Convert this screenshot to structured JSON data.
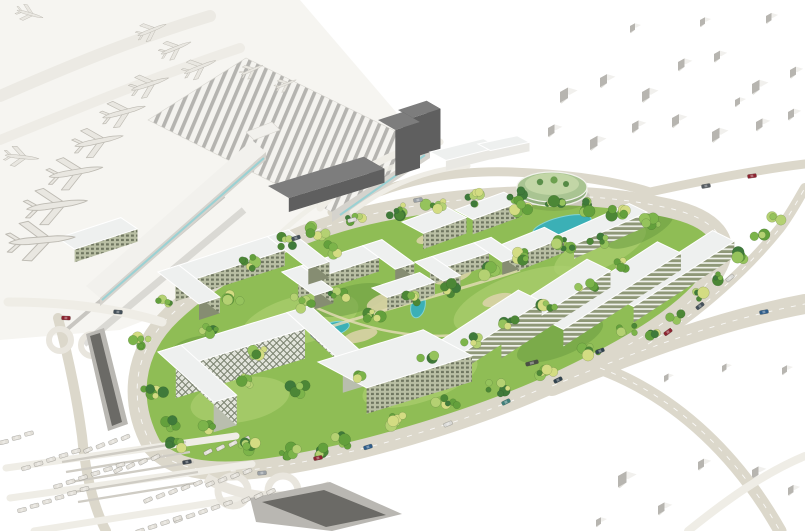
{
  "scene": {
    "label": "Aerial rendering of an airport terminal with parked airplanes and a green office-campus masterplan surrounded by ring roads, ramps and parking",
    "canvas": {
      "w": 805,
      "h": 531
    }
  },
  "palette": {
    "bg": "#ffffff",
    "apron": "#f6f5f1",
    "taxiway": "#eceae4",
    "road": "#dcd8cb",
    "roadLight": "#efede6",
    "laneDash": "#ffffff",
    "island": "#8fbd55",
    "grassLight": "#aace6e",
    "grassDark": "#679a3f",
    "plaza": "#ddd3ab",
    "path": "#e5dcb8",
    "water": "#3bb0b6",
    "waterEdge": "#82d3d5",
    "roofLight": "#eef0ef",
    "roofEdge": "#ffffff",
    "facadeBase": "#b9bfa4",
    "facadeWindow": "#6f7660",
    "facadeBand": "#8f9878",
    "bandLight": "#eff1ea",
    "facadeSide": "#868d72",
    "diamondBase": "#e3e5dc",
    "diamondLine": "#79816e",
    "diamondSide": "#b9beae",
    "darkFace": "#5f5f5f",
    "darkSide": "#474747",
    "darkRoof": "#7d7d7d",
    "terminalWhite": "#f2f1ed",
    "terminalSide": "#d5d3cd",
    "stripe": "#b5b4b0",
    "stripeBg": "#f4f3ef",
    "glass": "#8fd0d4",
    "context": "#b7b5b0",
    "contextRoof": "#f1f0ed",
    "contextShadow": "#dcdad5",
    "plane": "#e9e7e1",
    "planeStroke": "#bdbab2",
    "carLot": "#e2dfd8",
    "carStroke": "#b3b0a8",
    "rampDark": "#6b6a66",
    "rampWall": "#e9e6de",
    "rampMid": "#b9b7b2",
    "garage": "#cfccc4",
    "transit": "#c8c6c1",
    "trees": [
      "#3f7a3a",
      "#4c8736",
      "#63a03c",
      "#7cb44a",
      "#95c35c",
      "#b4d172",
      "#d3dc82"
    ]
  },
  "context_blocks": [
    [
      560,
      92,
      16
    ],
    [
      600,
      78,
      14
    ],
    [
      642,
      92,
      15
    ],
    [
      678,
      62,
      13
    ],
    [
      714,
      54,
      12
    ],
    [
      752,
      84,
      15
    ],
    [
      790,
      70,
      12
    ],
    [
      548,
      128,
      13
    ],
    [
      590,
      140,
      15
    ],
    [
      632,
      124,
      13
    ],
    [
      672,
      118,
      14
    ],
    [
      712,
      132,
      15
    ],
    [
      756,
      122,
      13
    ],
    [
      788,
      112,
      12
    ],
    [
      630,
      26,
      10
    ],
    [
      700,
      20,
      10
    ],
    [
      766,
      16,
      11
    ],
    [
      735,
      100,
      10
    ],
    [
      618,
      476,
      17
    ],
    [
      658,
      506,
      13
    ],
    [
      698,
      462,
      12
    ],
    [
      752,
      470,
      13
    ],
    [
      788,
      488,
      11
    ],
    [
      664,
      376,
      9
    ],
    [
      722,
      366,
      9
    ],
    [
      782,
      368,
      10
    ],
    [
      596,
      520,
      10
    ]
  ],
  "planes": [
    [
      30,
      14,
      16,
      0.8
    ],
    [
      22,
      157,
      6,
      1.0
    ],
    [
      252,
      70,
      -24,
      0.7
    ],
    [
      286,
      84,
      -22,
      0.65
    ],
    [
      152,
      30,
      -22,
      0.9
    ],
    [
      176,
      48,
      -22,
      0.95
    ],
    [
      200,
      67,
      -22,
      1.0
    ],
    [
      150,
      84,
      -18,
      1.15
    ],
    [
      124,
      112,
      -15,
      1.3
    ],
    [
      99,
      141,
      -12,
      1.45
    ],
    [
      76,
      172,
      -10,
      1.6
    ],
    [
      57,
      205,
      -8,
      1.8
    ],
    [
      42,
      240,
      -5,
      1.95
    ]
  ],
  "buildings": [
    {
      "id": "airside-tower-a",
      "x": 398,
      "y": 110,
      "len": 30,
      "wid": 16,
      "h": 40,
      "a1": -18,
      "a2": 30,
      "facade": "dark"
    },
    {
      "id": "airside-tower-b",
      "x": 378,
      "y": 120,
      "len": 26,
      "wid": 20,
      "h": 46,
      "a1": -18,
      "a2": 30,
      "facade": "dark"
    },
    {
      "id": "terminal-annex-a",
      "x": 430,
      "y": 152,
      "len": 55,
      "wid": 18,
      "h": 10,
      "a1": -14,
      "a2": 28,
      "facade": "light"
    },
    {
      "id": "terminal-annex-b",
      "x": 478,
      "y": 144,
      "len": 40,
      "wid": 14,
      "h": 9,
      "a1": -12,
      "a2": 28,
      "facade": "light"
    },
    {
      "id": "dark-office-slab",
      "x": 268,
      "y": 186,
      "len": 100,
      "wid": 24,
      "h": 14,
      "a1": -17,
      "a2": 30,
      "facade": "dark"
    },
    {
      "id": "campus-block-1",
      "x": 455,
      "y": 210,
      "len": 52,
      "wid": 20,
      "h": 15,
      "a1": -20,
      "a2": 28,
      "facade": "grid"
    },
    {
      "id": "campus-block-2",
      "x": 402,
      "y": 222,
      "len": 46,
      "wid": 24,
      "h": 16,
      "a1": -20,
      "a2": 28,
      "facade": "grid"
    },
    {
      "id": "top-row-slab",
      "x": 556,
      "y": 236,
      "len": 80,
      "wid": 20,
      "h": 14,
      "a1": -24,
      "a2": 26,
      "facade": "bands"
    },
    {
      "id": "campus-block-3",
      "x": 498,
      "y": 246,
      "len": 50,
      "wid": 22,
      "h": 15,
      "a1": -22,
      "a2": 28,
      "facade": "grid"
    },
    {
      "id": "u-building-north",
      "x": 415,
      "y": 262,
      "len": 62,
      "wid": 18,
      "h": 13,
      "a1": -18,
      "a2": 34,
      "facade": "grid",
      "wings": 34
    },
    {
      "id": "left-edge-slab",
      "x": 58,
      "y": 238,
      "len": 66,
      "wid": 20,
      "h": 13,
      "a1": -18,
      "a2": 34,
      "facade": "grid"
    },
    {
      "id": "u-building-center",
      "x": 282,
      "y": 272,
      "len": 85,
      "wid": 20,
      "h": 14,
      "a1": -18,
      "a2": 36,
      "facade": "grid",
      "wings": 40
    },
    {
      "id": "u-building-west",
      "x": 158,
      "y": 272,
      "len": 115,
      "wid": 22,
      "h": 16,
      "a1": -18,
      "a2": 38,
      "facade": "grid",
      "wings": 52
    },
    {
      "id": "mid-slab",
      "x": 372,
      "y": 288,
      "len": 50,
      "wid": 18,
      "h": 13,
      "a1": -18,
      "a2": 32,
      "facade": "grid"
    },
    {
      "id": "row-slab-4",
      "x": 612,
      "y": 296,
      "len": 120,
      "wid": 24,
      "h": 16,
      "a1": -33,
      "a2": 26,
      "facade": "bands"
    },
    {
      "id": "row-slab-3",
      "x": 540,
      "y": 318,
      "len": 140,
      "wid": 26,
      "h": 17,
      "a1": -33,
      "a2": 26,
      "facade": "bands"
    },
    {
      "id": "row-slab-2",
      "x": 478,
      "y": 330,
      "len": 130,
      "wid": 26,
      "h": 17,
      "a1": -33,
      "a2": 26,
      "facade": "bands"
    },
    {
      "id": "row-slab-1",
      "x": 426,
      "y": 350,
      "len": 110,
      "wid": 26,
      "h": 17,
      "a1": -33,
      "a2": 26,
      "facade": "bands"
    },
    {
      "id": "lattice-building",
      "x": 158,
      "y": 352,
      "len": 135,
      "wid": 24,
      "h": 30,
      "a1": -17,
      "a2": 42,
      "facade": "diamond",
      "wings": 75
    },
    {
      "id": "south-block",
      "x": 318,
      "y": 362,
      "len": 110,
      "wid": 55,
      "h": 26,
      "a1": -17,
      "a2": 28,
      "facade": "grid"
    }
  ],
  "ponds": [
    {
      "x": 562,
      "y": 226,
      "rx": 30,
      "ry": 9,
      "rot": -14
    },
    {
      "x": 602,
      "y": 238,
      "rx": 12,
      "ry": 5,
      "rot": -18
    },
    {
      "x": 330,
      "y": 330,
      "rx": 20,
      "ry": 7,
      "rot": -16
    },
    {
      "x": 418,
      "y": 306,
      "rx": 7,
      "ry": 12,
      "rot": 14
    },
    {
      "x": 478,
      "y": 258,
      "rx": 10,
      "ry": 4,
      "rot": -14
    }
  ],
  "tree_clusters": [
    [
      252,
      262,
      12,
      6
    ],
    [
      284,
      242,
      11,
      6
    ],
    [
      318,
      230,
      12,
      7
    ],
    [
      356,
      220,
      11,
      6
    ],
    [
      396,
      210,
      12,
      7
    ],
    [
      436,
      203,
      11,
      6
    ],
    [
      476,
      198,
      12,
      7
    ],
    [
      516,
      196,
      11,
      6
    ],
    [
      556,
      202,
      10,
      5
    ],
    [
      586,
      208,
      12,
      7
    ],
    [
      620,
      212,
      11,
      6
    ],
    [
      652,
      222,
      10,
      5
    ],
    [
      300,
      302,
      12,
      6
    ],
    [
      336,
      296,
      11,
      5
    ],
    [
      372,
      316,
      12,
      6
    ],
    [
      410,
      300,
      10,
      5
    ],
    [
      448,
      288,
      11,
      6
    ],
    [
      486,
      272,
      12,
      6
    ],
    [
      524,
      256,
      11,
      6
    ],
    [
      562,
      246,
      12,
      7
    ],
    [
      598,
      240,
      10,
      5
    ],
    [
      204,
      428,
      12,
      6
    ],
    [
      244,
      446,
      13,
      7
    ],
    [
      292,
      452,
      12,
      6
    ],
    [
      344,
      440,
      12,
      6
    ],
    [
      396,
      420,
      12,
      6
    ],
    [
      446,
      404,
      12,
      6
    ],
    [
      496,
      388,
      12,
      6
    ],
    [
      544,
      372,
      11,
      6
    ],
    [
      588,
      352,
      11,
      5
    ],
    [
      628,
      330,
      10,
      5
    ],
    [
      162,
      300,
      10,
      5
    ],
    [
      142,
      342,
      11,
      6
    ],
    [
      152,
      392,
      12,
      6
    ],
    [
      176,
      424,
      11,
      6
    ],
    [
      654,
      334,
      8,
      4
    ],
    [
      676,
      316,
      8,
      4
    ],
    [
      698,
      296,
      8,
      4
    ],
    [
      718,
      276,
      8,
      4
    ],
    [
      738,
      256,
      8,
      4
    ],
    [
      758,
      236,
      7,
      3
    ],
    [
      774,
      220,
      7,
      3
    ],
    [
      262,
      352,
      10,
      5
    ],
    [
      300,
      388,
      11,
      6
    ],
    [
      356,
      378,
      10,
      5
    ],
    [
      428,
      360,
      10,
      5
    ],
    [
      470,
      340,
      10,
      5
    ],
    [
      508,
      322,
      10,
      5
    ],
    [
      548,
      306,
      10,
      5
    ],
    [
      586,
      286,
      10,
      5
    ],
    [
      622,
      264,
      10,
      5
    ],
    [
      330,
      250,
      10,
      5
    ],
    [
      230,
      300,
      10,
      5
    ],
    [
      210,
      330,
      10,
      6
    ],
    [
      250,
      380,
      10,
      5
    ],
    [
      176,
      444,
      10,
      6
    ],
    [
      318,
      452,
      10,
      6
    ],
    [
      520,
      208,
      9,
      5
    ]
  ],
  "road_cars": [
    [
      187,
      462,
      -10,
      "#3d464f"
    ],
    [
      262,
      473,
      -4,
      "#9aa0a6"
    ],
    [
      318,
      458,
      -12,
      "#8c2430"
    ],
    [
      368,
      447,
      -17,
      "#2f5d8a"
    ],
    [
      448,
      424,
      -22,
      "#d9d9d6"
    ],
    [
      506,
      402,
      -26,
      "#3f7f7a"
    ],
    [
      558,
      380,
      -26,
      "#30424e"
    ],
    [
      668,
      332,
      -36,
      "#8c2430"
    ],
    [
      700,
      306,
      -38,
      "#44505a"
    ],
    [
      730,
      278,
      -40,
      "#d8d8d4"
    ],
    [
      706,
      186,
      -10,
      "#555b61"
    ],
    [
      752,
      176,
      -8,
      "#8c2430"
    ],
    [
      118,
      312,
      4,
      "#44505a"
    ],
    [
      66,
      318,
      2,
      "#8c2430"
    ],
    [
      352,
      220,
      -14,
      "#d9d9d6"
    ],
    [
      296,
      238,
      -18,
      "#44505a"
    ],
    [
      418,
      200,
      -10,
      "#9aa0a6"
    ],
    [
      764,
      312,
      -10,
      "#2f5d8a"
    ],
    [
      600,
      351,
      -22,
      "#30424e"
    ],
    [
      532,
      363,
      -14,
      "#4a4f45",
      13
    ]
  ],
  "parking_rows": [
    [
      26,
      468,
      -16,
      5
    ],
    [
      58,
      486,
      -16,
      6
    ],
    [
      22,
      510,
      -14,
      6
    ],
    [
      118,
      470,
      -28,
      4
    ],
    [
      148,
      500,
      -24,
      5
    ],
    [
      208,
      452,
      -28,
      4
    ],
    [
      88,
      450,
      -24,
      4
    ],
    [
      178,
      520,
      -20,
      5
    ],
    [
      246,
      500,
      -26,
      3
    ],
    [
      4,
      442,
      -14,
      3
    ],
    [
      210,
      484,
      -24,
      4
    ],
    [
      140,
      531,
      -18,
      4
    ]
  ]
}
